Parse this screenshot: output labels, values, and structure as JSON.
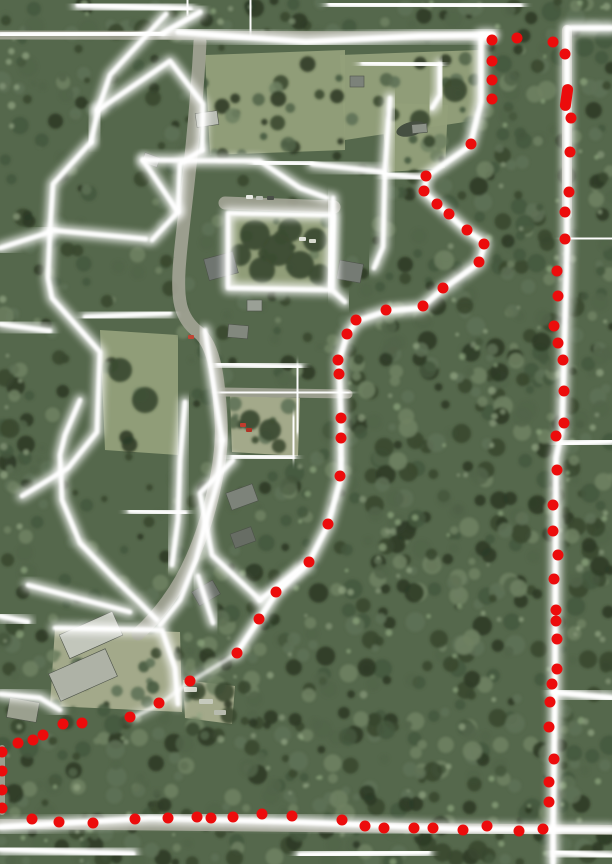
{
  "meta": {
    "kind": "aerial-photo-parcel-boundary-map",
    "width": 612,
    "height": 864
  },
  "palette": {
    "forest_base": "#55684c",
    "forest_shades": [
      "#46583e",
      "#39482f",
      "#5e7155",
      "#6e8162",
      "#52644a",
      "#2c3a26"
    ],
    "forest_highlights": [
      "#87997a",
      "#93a583",
      "#8ea67f"
    ],
    "clearing": "#93a07a",
    "clearing_light": "#a8ad8d",
    "road": "#a3a496",
    "parking": "#a8a99b",
    "pond": "#454f41",
    "line_glow": "#ffffff",
    "dot_red": "#ec0c0c"
  },
  "map": {
    "boundary_dots": [
      [
        492,
        40
      ],
      [
        517,
        38
      ],
      [
        553,
        42
      ],
      [
        565,
        54
      ],
      [
        492,
        61
      ],
      [
        492,
        80
      ],
      [
        492,
        99
      ],
      [
        571,
        118
      ],
      [
        570,
        152
      ],
      [
        569,
        192
      ],
      [
        565,
        212
      ],
      [
        565,
        239
      ],
      [
        557,
        271
      ],
      [
        558,
        296
      ],
      [
        554,
        326
      ],
      [
        558,
        343
      ],
      [
        563,
        360
      ],
      [
        564,
        391
      ],
      [
        564,
        423
      ],
      [
        556,
        436
      ],
      [
        557,
        470
      ],
      [
        553,
        505
      ],
      [
        553,
        531
      ],
      [
        558,
        555
      ],
      [
        554,
        579
      ],
      [
        556,
        610
      ],
      [
        556,
        621
      ],
      [
        557,
        639
      ],
      [
        557,
        669
      ],
      [
        552,
        684
      ],
      [
        550,
        702
      ],
      [
        549,
        727
      ],
      [
        554,
        759
      ],
      [
        549,
        782
      ],
      [
        549,
        802
      ],
      [
        543,
        829
      ],
      [
        471,
        144
      ],
      [
        426,
        176
      ],
      [
        424,
        191
      ],
      [
        437,
        204
      ],
      [
        449,
        214
      ],
      [
        467,
        230
      ],
      [
        484,
        244
      ],
      [
        479,
        262
      ],
      [
        443,
        288
      ],
      [
        423,
        306
      ],
      [
        386,
        310
      ],
      [
        356,
        320
      ],
      [
        347,
        334
      ],
      [
        338,
        360
      ],
      [
        339,
        374
      ],
      [
        341,
        418
      ],
      [
        341,
        438
      ],
      [
        340,
        476
      ],
      [
        328,
        524
      ],
      [
        309,
        562
      ],
      [
        276,
        592
      ],
      [
        259,
        619
      ],
      [
        237,
        653
      ],
      [
        190,
        681
      ],
      [
        159,
        703
      ],
      [
        130,
        717
      ],
      [
        82,
        723
      ],
      [
        63,
        724
      ],
      [
        43,
        735
      ],
      [
        33,
        740
      ],
      [
        18,
        743
      ],
      [
        2,
        752
      ],
      [
        2,
        771
      ],
      [
        2,
        790
      ],
      [
        2,
        808
      ],
      [
        32,
        819
      ],
      [
        59,
        822
      ],
      [
        93,
        823
      ],
      [
        135,
        819
      ],
      [
        168,
        818
      ],
      [
        197,
        817
      ],
      [
        211,
        818
      ],
      [
        233,
        817
      ],
      [
        262,
        814
      ],
      [
        292,
        816
      ],
      [
        342,
        820
      ],
      [
        365,
        826
      ],
      [
        384,
        828
      ],
      [
        414,
        828
      ],
      [
        433,
        828
      ],
      [
        463,
        830
      ],
      [
        487,
        826
      ],
      [
        519,
        831
      ]
    ],
    "dot_radius": 5.5,
    "boundary_dash": {
      "x": 561,
      "y": 84,
      "w": 11,
      "h": 27,
      "rot": 8
    },
    "white_lines": {
      "roads": [
        "M0,35 L163,33",
        "M78,5 L190,9",
        "M163,33 L200,12",
        "M178,32 L306,42 L420,36 L492,35",
        "M250,1 L251,29",
        "M187,0 L188,12",
        "M330,4 L520,6",
        "M612,28 L567,28 L567,250 L562,430 L556,458 L555,698 L553,830 L553,864",
        "M567,238 L612,239",
        "M553,692 L612,698",
        "M560,444 L612,441",
        "M0,827 L150,818 L300,822 L460,829 L612,830",
        "M0,849 L133,854",
        "M300,855 L428,852",
        "M556,852 L612,856",
        "M4,745 L4,815"
      ],
      "boundary": [
        "M492,35 L481,35 L481,102 L470,146 L427,176 L424,192 L449,215 L467,231 L485,243 L479,263 L443,289 L421,308 L387,311 L357,321 L347,335 L339,361 L341,420 L341,478 L328,525 L309,562 L276,593 L258,621 L236,654"
      ],
      "boundary_faint": [
        "M236,654 L190,682 L160,704 L132,718"
      ],
      "parcels": [
        "M166,14 L110,75 L98,110",
        "M98,110 L170,61 L203,104 L202,150",
        "M98,110 L91,142",
        "M202,150 L180,164 L178,212 L152,240",
        "M91,142 L53,184 L50,230 L146,239",
        "M0,248 L50,232",
        "M85,317 L170,313",
        "M0,324 L50,331",
        "M50,230 L48,278 L52,298 L100,352 L97,432 L68,468 L22,496",
        "M228,213 L333,215 L330,290 L228,288 L228,213",
        "M143,160 L260,161 L300,188 L327,198",
        "M178,212 L143,160",
        "M255,162 L312,164",
        "M230,56 L230,150",
        "M255,55 L255,150",
        "M308,52 L308,152",
        "M360,36 L360,152",
        "M363,63 L440,65",
        "M440,64 L440,95 L432,108",
        "M390,98 L385,170 L383,247 L374,268",
        "M385,174 L424,178",
        "M312,164 L383,172",
        "M333,198 L332,290 L345,302",
        "M205,330 L215,395 L222,440",
        "M218,364 L300,367",
        "M298,367 L297,431",
        "M222,392 L348,393",
        "M233,456 L293,458",
        "M294,418 L293,457",
        "M255,393 L255,452",
        "M233,460 L200,493 L205,520 L212,555 L260,600",
        "M260,600 L305,565",
        "M80,400 L65,435 L60,455 L62,500 L80,543 L113,577 L140,603 L157,620",
        "M130,511 L185,513",
        "M222,440 L218,480 L205,525 L196,560 L180,600 L160,625",
        "M185,402 L180,460 L178,520 L172,565",
        "M55,628 L162,630 L175,668 L178,704",
        "M28,585 L130,612",
        "M0,616 L28,622",
        "M198,576 L213,623",
        "M0,694 L40,698 L60,710"
      ]
    },
    "road_ribbons": [
      {
        "d": "M200,42 C195,140 182,230 180,258 C176,300 180,318 198,332 C216,346 219,385 221,420 C224,462 208,522 192,558 C178,590 158,616 138,634",
        "w": 13
      },
      {
        "d": "M225,203 L334,207",
        "w": 13
      },
      {
        "d": "M222,392 L348,394",
        "w": 9
      },
      {
        "d": "M0,35 L492,36",
        "w": 9
      },
      {
        "d": "M567,30 L567,215",
        "w": 10
      },
      {
        "d": "M0,824 L612,830",
        "w": 10
      },
      {
        "d": "M2,748 L2,812",
        "w": 6
      }
    ],
    "clearings": [
      {
        "pts": "380,103 448,105 445,168 388,172",
        "light": false
      },
      {
        "pts": "228,213 333,215 330,290 228,288",
        "light": false
      },
      {
        "pts": "100,330 178,335 178,455 105,450",
        "light": false
      },
      {
        "pts": "230,396 300,398 298,456 232,452",
        "light": true
      },
      {
        "pts": "55,628 180,632 182,712 50,706",
        "light": true
      },
      {
        "pts": "183,680 235,686 232,724 185,718",
        "light": true
      },
      {
        "pts": "340,55 480,50 478,120 345,140",
        "light": false
      },
      {
        "pts": "205,55 345,50 345,150 210,155",
        "light": false
      }
    ],
    "tree_clumps": [
      [
        255,
        235,
        15
      ],
      [
        278,
        250,
        16
      ],
      [
        300,
        265,
        14
      ],
      [
        262,
        270,
        13
      ],
      [
        315,
        240,
        12
      ],
      [
        240,
        255,
        11
      ],
      [
        290,
        230,
        12
      ],
      [
        320,
        275,
        11
      ],
      [
        120,
        370,
        12
      ],
      [
        145,
        400,
        13
      ],
      [
        250,
        420,
        10
      ],
      [
        270,
        430,
        11
      ],
      [
        420,
        120,
        10
      ],
      [
        455,
        90,
        12
      ]
    ],
    "pond": {
      "cx": 411,
      "cy": 129,
      "rx": 15,
      "ry": 7,
      "rot": -15
    },
    "houses": [
      {
        "x": 196,
        "y": 112,
        "w": 22,
        "h": 14,
        "rot": -8,
        "c": "#b9bdb4"
      },
      {
        "x": 143,
        "y": 155,
        "w": 16,
        "h": 10,
        "rot": 20,
        "c": "#8f958b"
      },
      {
        "x": 206,
        "y": 255,
        "w": 30,
        "h": 22,
        "rot": -15,
        "c": "#6f7570"
      },
      {
        "x": 338,
        "y": 262,
        "w": 24,
        "h": 19,
        "rot": 10,
        "c": "#757b74"
      },
      {
        "x": 247,
        "y": 300,
        "w": 15,
        "h": 11,
        "rot": 0,
        "c": "#9aa096"
      },
      {
        "x": 228,
        "y": 325,
        "w": 20,
        "h": 13,
        "rot": 5,
        "c": "#82887e"
      },
      {
        "x": 228,
        "y": 488,
        "w": 28,
        "h": 18,
        "rot": -20,
        "c": "#7d837a"
      },
      {
        "x": 232,
        "y": 530,
        "w": 22,
        "h": 15,
        "rot": -20,
        "c": "#676d64"
      },
      {
        "x": 62,
        "y": 622,
        "w": 58,
        "h": 26,
        "rot": -24,
        "c": "#c2c6bb"
      },
      {
        "x": 52,
        "y": 660,
        "w": 62,
        "h": 30,
        "rot": -24,
        "c": "#aeb2a6"
      },
      {
        "x": 194,
        "y": 585,
        "w": 24,
        "h": 16,
        "rot": -30,
        "c": "#6b716a"
      },
      {
        "x": 350,
        "y": 76,
        "w": 14,
        "h": 11,
        "rot": 0,
        "c": "#7c827a"
      },
      {
        "x": 412,
        "y": 124,
        "w": 15,
        "h": 9,
        "rot": -5,
        "c": "#8c9288"
      },
      {
        "x": 8,
        "y": 700,
        "w": 30,
        "h": 20,
        "rot": 10,
        "c": "#9ba08f"
      }
    ],
    "vehicles": [
      {
        "x": 246,
        "y": 195,
        "w": 7,
        "h": 4,
        "c": "#e8eae4"
      },
      {
        "x": 256,
        "y": 196,
        "w": 7,
        "h": 4,
        "c": "#b9bdb4"
      },
      {
        "x": 267,
        "y": 196,
        "w": 7,
        "h": 4,
        "c": "#4a4f48"
      },
      {
        "x": 299,
        "y": 237,
        "w": 7,
        "h": 4,
        "c": "#dfe2da"
      },
      {
        "x": 309,
        "y": 239,
        "w": 7,
        "h": 4,
        "c": "#d7dacf"
      },
      {
        "x": 240,
        "y": 423,
        "w": 6,
        "h": 4,
        "c": "#c23b2e"
      },
      {
        "x": 246,
        "y": 428,
        "w": 6,
        "h": 4,
        "c": "#b03325"
      },
      {
        "x": 188,
        "y": 335,
        "w": 6,
        "h": 4,
        "c": "#bf4433"
      },
      {
        "x": 184,
        "y": 687,
        "w": 13,
        "h": 5,
        "c": "#ced2c6"
      },
      {
        "x": 199,
        "y": 699,
        "w": 14,
        "h": 5,
        "c": "#c6cabd"
      },
      {
        "x": 214,
        "y": 710,
        "w": 12,
        "h": 5,
        "c": "#b7bbae"
      }
    ]
  }
}
